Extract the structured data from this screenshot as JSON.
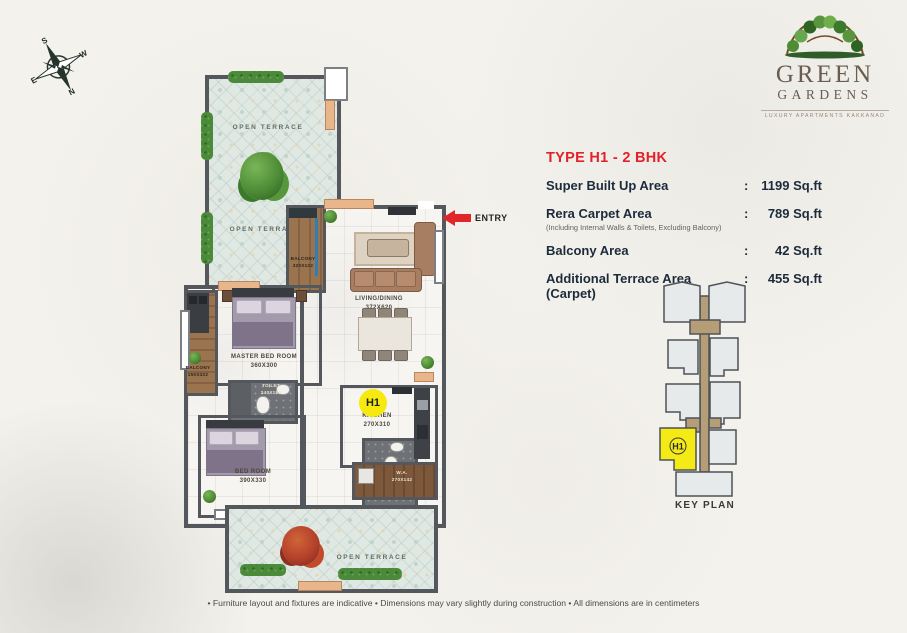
{
  "page": {
    "disclaimer": "•  Furniture layout and fixtures are indicative  •  Dimensions may vary slightly during construction  •  All dimensions are in centimeters"
  },
  "logo": {
    "line1": "GREEN",
    "line2": "GARDENS",
    "tagline": "Luxury Apartments Kakkanad"
  },
  "compass": {
    "top": "S",
    "right": "W",
    "bottom": "N",
    "left": "E"
  },
  "info": {
    "title": "TYPE H1 - 2 BHK",
    "rows": [
      {
        "label": "Super Built Up Area",
        "sep": ":",
        "value": "1199 Sq.ft"
      },
      {
        "label": "Rera Carpet Area",
        "sep": ":",
        "value": "789 Sq.ft",
        "note": "(Including Internal Walls & Toilets, Excluding Balcony)"
      },
      {
        "label": "Balcony Area",
        "sep": ":",
        "value": "42 Sq.ft"
      },
      {
        "label": "Additional Terrace Area (Carpet)",
        "sep": ":",
        "value": "455 Sq.ft"
      }
    ]
  },
  "keyplan": {
    "label": "KEY PLAN",
    "unit": "H1"
  },
  "floorplan": {
    "entry": "ENTRY",
    "badge": "H1",
    "terrace_top_1": "OPEN TERRACE",
    "terrace_top_2": "OPEN TERRACE",
    "terrace_bottom": "OPEN TERRACE",
    "living": {
      "name": "LIVING/DINING",
      "dim": "372X620"
    },
    "balcony_living": {
      "name": "BALCONY",
      "dim": "320X122"
    },
    "master": {
      "name": "MASTER BED ROOM",
      "dim": "360X300"
    },
    "toilet_master": {
      "name": "TOILET",
      "dim": "240X150"
    },
    "balcony_master": {
      "name": "BALCONY",
      "dim": "150X322"
    },
    "bedroom": {
      "name": "BED ROOM",
      "dim": "390X330"
    },
    "toilet2": {
      "name": "TOILET",
      "dim": "150X240"
    },
    "kitchen": {
      "name": "KITCHEN",
      "dim": "270X310"
    },
    "work_area": {
      "name": "W.A.",
      "dim": "270X142"
    }
  }
}
